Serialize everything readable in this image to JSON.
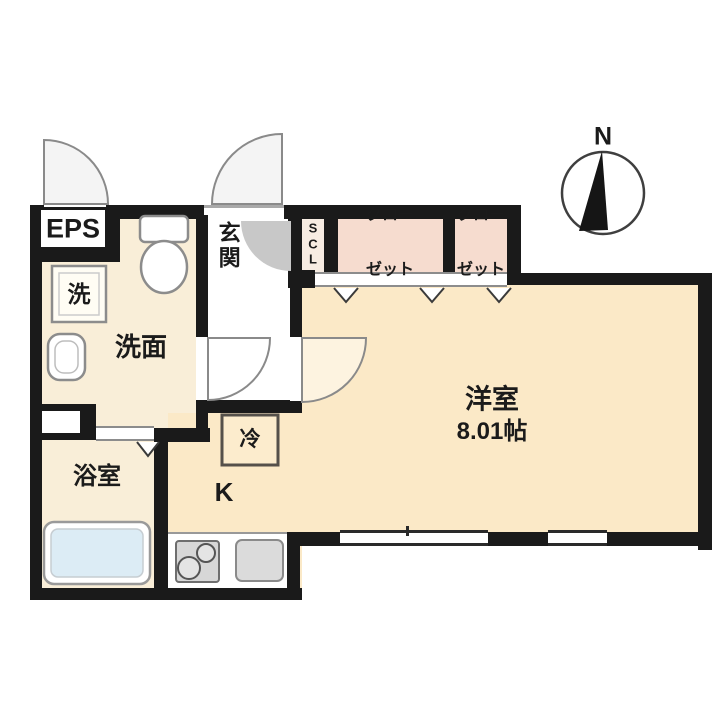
{
  "floorplan": {
    "compass": {
      "label": "N"
    },
    "rooms": {
      "eps": {
        "label": "EPS"
      },
      "entrance": {
        "label": "玄関"
      },
      "shoe_closet": {
        "letters": [
          "S",
          "C",
          "L"
        ]
      },
      "closet_left": {
        "lines": [
          "クロー",
          "ゼット"
        ]
      },
      "closet_right": {
        "lines": [
          "クロー",
          "ゼット"
        ]
      },
      "washroom": {
        "label": "洗面"
      },
      "washing_machine": {
        "label": "洗"
      },
      "bathroom": {
        "label": "浴室"
      },
      "kitchen": {
        "label": "K"
      },
      "refrigerator": {
        "label": "冷"
      },
      "western_room": {
        "label": "洋室",
        "size": "8.01帖"
      }
    },
    "colors": {
      "wall": "#1a1a1a",
      "floor_main": "#fbe9c7",
      "floor_wet": "#f9eed8",
      "closet": "#f6dccf",
      "shoe_closet": "#f7ece2",
      "bathtub": "#dcecf5",
      "kitchen_fixture": "#d9d9d9",
      "door_swing": "#c8c8c8"
    }
  }
}
